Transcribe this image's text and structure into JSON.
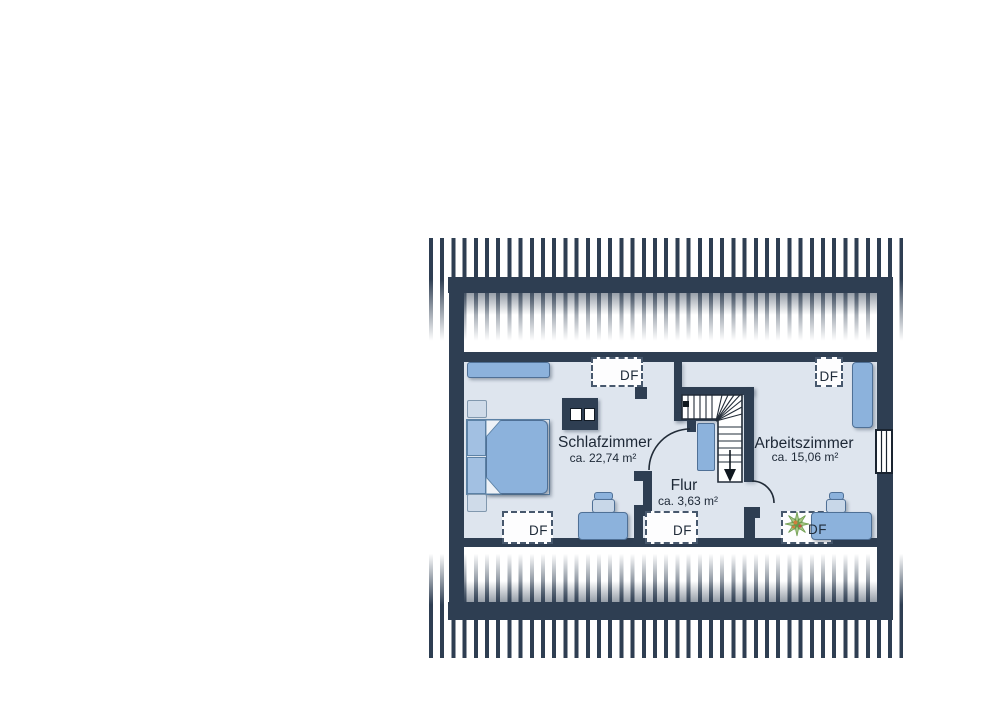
{
  "labels": {
    "roof_window": "DF"
  },
  "rooms": [
    {
      "id": "schlafzimmer",
      "name": "Schlafzimmer",
      "area": "ca. 22,74 m²"
    },
    {
      "id": "flur",
      "name": "Flur",
      "area": "ca. 3,63 m²"
    },
    {
      "id": "arbeitszimmer",
      "name": "Arbeitszimmer",
      "area": "ca. 15,06 m²"
    }
  ],
  "colors": {
    "wall_navy": "#2e3e52",
    "room_fill": "#dee5ee",
    "furniture_blue": "#8cb2dc",
    "furniture_light": "#cfdbe9",
    "stair_white": "#ffffff",
    "plant_green_light": "#a9c785",
    "plant_green_dark": "#5f9444",
    "plant_orange": "#cf7f3e"
  },
  "symbols": [
    "roof-hatch",
    "bed",
    "sideboard",
    "dresser",
    "nightstand",
    "pillow",
    "wardrobe",
    "desk",
    "swivel-chair",
    "cabinet",
    "staircase",
    "roof-window-df",
    "gable-window",
    "chimney",
    "plant",
    "door-swing-arc"
  ]
}
